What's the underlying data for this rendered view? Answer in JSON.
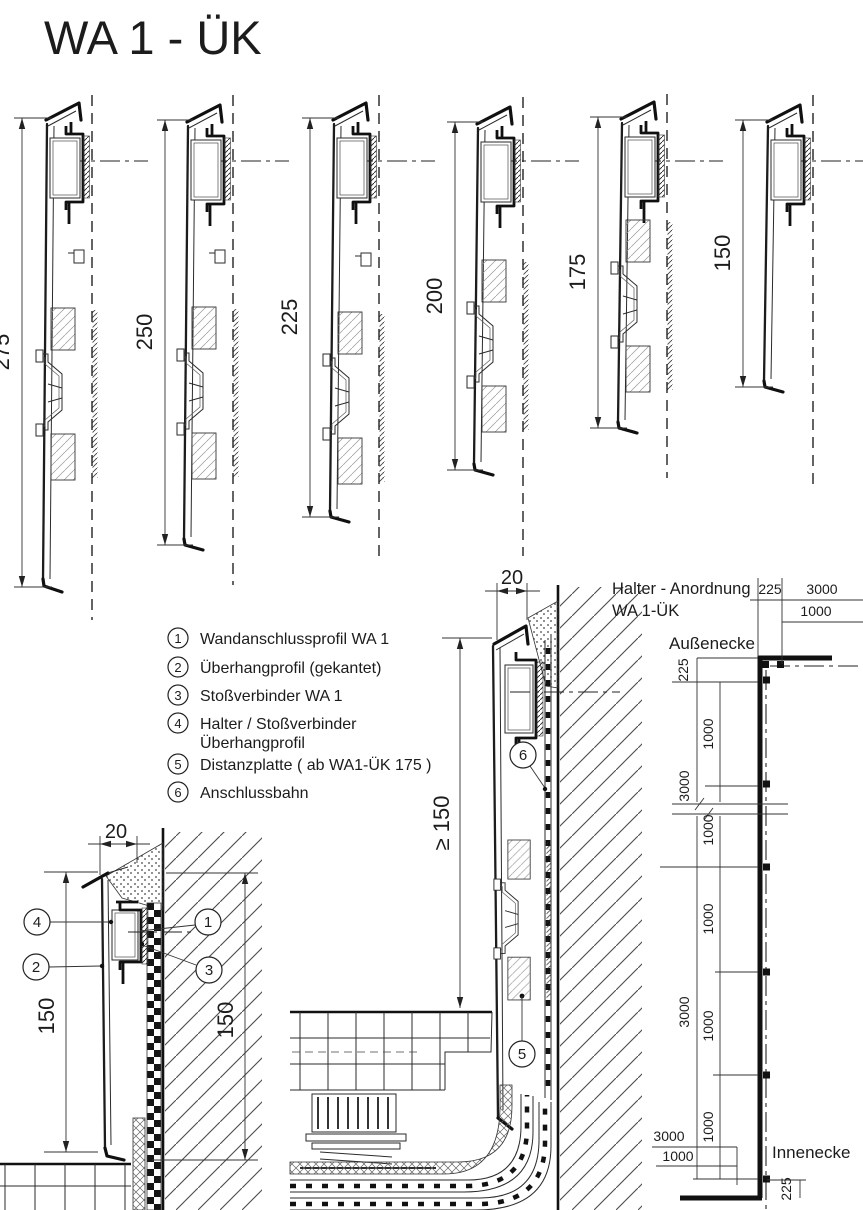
{
  "title": "WA 1 - ÜK",
  "profiles": [
    {
      "height": "275"
    },
    {
      "height": "250"
    },
    {
      "height": "225"
    },
    {
      "height": "200"
    },
    {
      "height": "175"
    },
    {
      "height": "150"
    }
  ],
  "legend": {
    "items": [
      {
        "num": "1",
        "label": "Wandanschlussprofil  WA 1"
      },
      {
        "num": "2",
        "label": "Überhangprofil (gekantet)"
      },
      {
        "num": "3",
        "label": "Stoßverbinder  WA 1"
      },
      {
        "num": "4",
        "label": "Halter / Stoßverbinder",
        "label2": "Überhangprofil"
      },
      {
        "num": "5",
        "label": "Distanzplatte  ( ab WA1-ÜK 175 )"
      },
      {
        "num": "6",
        "label": "Anschlussbahn"
      }
    ]
  },
  "detail_left": {
    "dim20": "20",
    "dim150_left": "150",
    "dim150_right": "150",
    "c4": "4",
    "c2": "2",
    "c1": "1",
    "c3": "3"
  },
  "detail_middle": {
    "dim20": "20",
    "dim_ge150": "≥ 150",
    "c6": "6",
    "c5": "5"
  },
  "halter": {
    "title1": "Halter - Anordnung",
    "title2": "WA 1-ÜK",
    "outer_label": "Außenecke",
    "inner_label": "Innenecke",
    "d_top225": "225",
    "d_top3000": "3000",
    "d_top1000": "1000",
    "d_left225": "225",
    "d_v1000a": "1000",
    "d_v3000a": "3000",
    "d_v1000b": "1000",
    "d_v1000c": "1000",
    "d_v3000b": "3000",
    "d_v1000d": "1000",
    "d_v1000e": "1000",
    "d_b3000": "3000",
    "d_b1000": "1000",
    "d_b225": "225"
  }
}
